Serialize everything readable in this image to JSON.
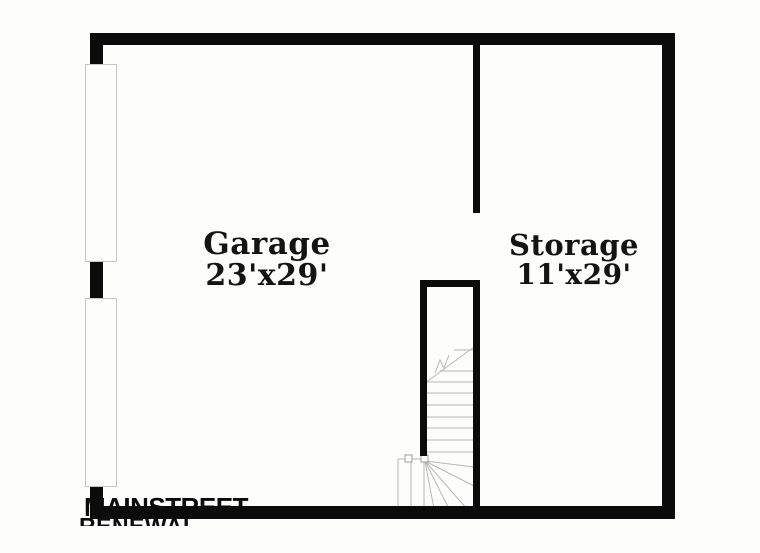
{
  "plan": {
    "title": "Basement / garage level floor plan",
    "rooms": [
      {
        "name": "Garage",
        "dimensions": "23'x29'"
      },
      {
        "name": "Storage",
        "dimensions": "11'x29'"
      }
    ]
  },
  "watermark": {
    "line1": "MAINSTREET",
    "line2": "RENEWAL"
  },
  "colors": {
    "background": "#fdfdfc",
    "wall": "#0b0b0b",
    "stair_line": "#b8b8b8",
    "door_border": "#c6c6c6",
    "label_text": "#141414"
  }
}
